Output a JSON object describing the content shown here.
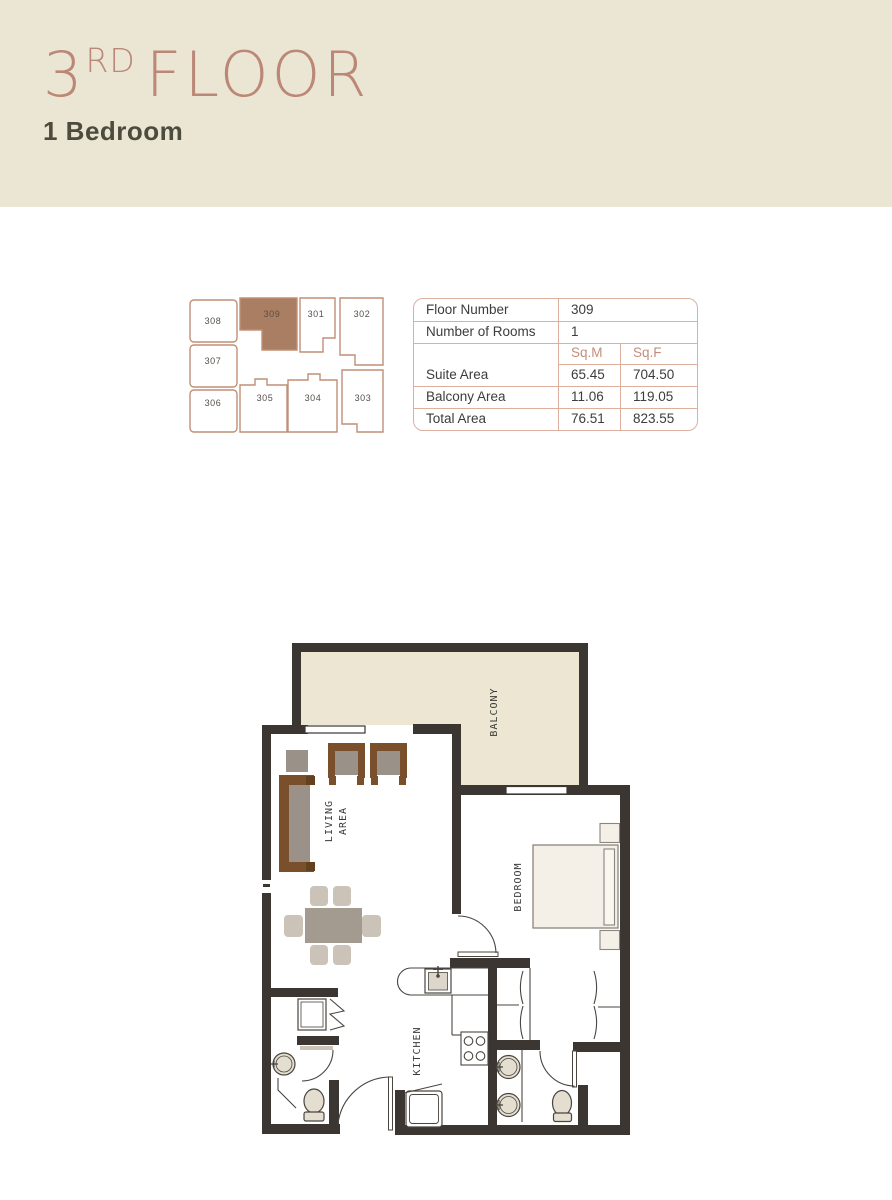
{
  "header": {
    "floor_number": "3",
    "floor_ordinal": "RD",
    "floor_word": "FLOOR",
    "subtitle": "1 Bedroom"
  },
  "key_plan": {
    "units": [
      "308",
      "309",
      "301",
      "302",
      "307",
      "306",
      "305",
      "304",
      "303"
    ],
    "highlighted_unit": "309"
  },
  "info_table": {
    "simple_rows": [
      {
        "label": "Floor Number",
        "value": "309"
      },
      {
        "label": "Number of Rooms",
        "value": "1"
      }
    ],
    "col_headers": [
      "Sq.M",
      "Sq.F"
    ],
    "area_rows": [
      {
        "label": "Suite Area",
        "sqm": "65.45",
        "sqf": "704.50"
      },
      {
        "label": "Balcony Area",
        "sqm": "11.06",
        "sqf": "119.05"
      },
      {
        "label": "Total Area",
        "sqm": "76.51",
        "sqf": "823.55"
      }
    ]
  },
  "floor_plan": {
    "labels": {
      "balcony": "BALCONY",
      "living_line1": "LIVING",
      "living_line2": "AREA",
      "bedroom": "BEDROOM",
      "kitchen": "KITCHEN"
    }
  },
  "colors": {
    "header_bg": "#ebe5d3",
    "accent_rose": "#bb8877",
    "subtitle_text": "#4c4b3d",
    "keyplan_outline": "#c08f77",
    "highlight_unit_fill": "#aa7e62",
    "table_border": "#ddb09e",
    "wall": "#3b3632",
    "balcony_fill": "#ede6d2"
  }
}
